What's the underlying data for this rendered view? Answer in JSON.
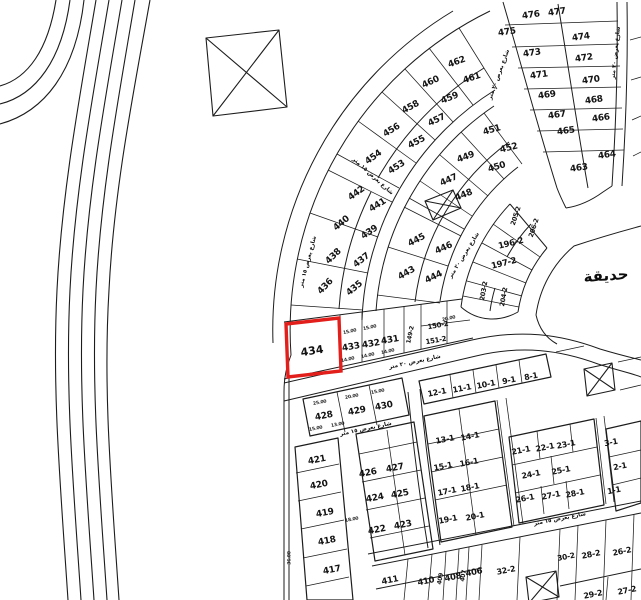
{
  "map": {
    "background_color": "#ffffff",
    "line_color": "#1c1c1c",
    "highlight_color": "#e31f1c",
    "park_label": "حديقة",
    "selected_plot": {
      "number": "434"
    },
    "plot_labels": [
      {
        "t": "435",
        "x": 355,
        "y": 289,
        "r": -40,
        "s": 9
      },
      {
        "t": "436",
        "x": 326,
        "y": 287,
        "r": -46,
        "s": 9
      },
      {
        "t": "437",
        "x": 362,
        "y": 261,
        "r": -38,
        "s": 9
      },
      {
        "t": "438",
        "x": 334,
        "y": 257,
        "r": -44,
        "s": 9
      },
      {
        "t": "439",
        "x": 370,
        "y": 233,
        "r": -34,
        "s": 9
      },
      {
        "t": "440",
        "x": 342,
        "y": 224,
        "r": -40,
        "s": 9
      },
      {
        "t": "441",
        "x": 378,
        "y": 206,
        "r": -32,
        "s": 9
      },
      {
        "t": "442",
        "x": 357,
        "y": 194,
        "r": -36,
        "s": 9
      },
      {
        "t": "453",
        "x": 397,
        "y": 168,
        "r": -33,
        "s": 9
      },
      {
        "t": "454",
        "x": 374,
        "y": 158,
        "r": -36,
        "s": 9
      },
      {
        "t": "455",
        "x": 417,
        "y": 143,
        "r": -28,
        "s": 9
      },
      {
        "t": "456",
        "x": 392,
        "y": 131,
        "r": -32,
        "s": 9
      },
      {
        "t": "457",
        "x": 437,
        "y": 121,
        "r": -26,
        "s": 9
      },
      {
        "t": "458",
        "x": 411,
        "y": 108,
        "r": -29,
        "s": 9
      },
      {
        "t": "459",
        "x": 450,
        "y": 99,
        "r": -22,
        "s": 9
      },
      {
        "t": "460",
        "x": 431,
        "y": 83,
        "r": -25,
        "s": 9
      },
      {
        "t": "461",
        "x": 472,
        "y": 79,
        "r": -18,
        "s": 9
      },
      {
        "t": "462",
        "x": 457,
        "y": 63,
        "r": -20,
        "s": 9
      },
      {
        "t": "443",
        "x": 407,
        "y": 274,
        "r": -30,
        "s": 9
      },
      {
        "t": "444",
        "x": 434,
        "y": 278,
        "r": -26,
        "s": 9
      },
      {
        "t": "445",
        "x": 417,
        "y": 241,
        "r": -28,
        "s": 9
      },
      {
        "t": "446",
        "x": 444,
        "y": 249,
        "r": -24,
        "s": 9
      },
      {
        "t": "447",
        "x": 449,
        "y": 181,
        "r": -24,
        "s": 9
      },
      {
        "t": "448",
        "x": 464,
        "y": 196,
        "r": -22,
        "s": 9
      },
      {
        "t": "449",
        "x": 466,
        "y": 158,
        "r": -20,
        "s": 9
      },
      {
        "t": "450",
        "x": 497,
        "y": 168,
        "r": -17,
        "s": 9
      },
      {
        "t": "451",
        "x": 492,
        "y": 131,
        "r": -16,
        "s": 9
      },
      {
        "t": "452",
        "x": 509,
        "y": 149,
        "r": -14,
        "s": 9
      },
      {
        "t": "433",
        "x": 351,
        "y": 348,
        "r": -10,
        "s": 9
      },
      {
        "t": "432",
        "x": 371,
        "y": 345,
        "r": -10,
        "s": 9
      },
      {
        "t": "431",
        "x": 390,
        "y": 341,
        "r": -10,
        "s": 9
      },
      {
        "t": "149-2",
        "x": 411,
        "y": 335,
        "r": -78,
        "s": 6
      },
      {
        "t": "150-2",
        "x": 438,
        "y": 326,
        "r": -10,
        "s": 7
      },
      {
        "t": "151-2",
        "x": 436,
        "y": 341,
        "r": -10,
        "s": 7
      },
      {
        "t": "205-2",
        "x": 516,
        "y": 216,
        "r": -72,
        "s": 6.5
      },
      {
        "t": "206-2",
        "x": 534,
        "y": 228,
        "r": -72,
        "s": 6.5
      },
      {
        "t": "196-2",
        "x": 511,
        "y": 244,
        "r": -14,
        "s": 8.5
      },
      {
        "t": "197-2",
        "x": 504,
        "y": 264,
        "r": -14,
        "s": 8.5
      },
      {
        "t": "203-2",
        "x": 484,
        "y": 291,
        "r": -80,
        "s": 6.5
      },
      {
        "t": "204-2",
        "x": 504,
        "y": 297,
        "r": -80,
        "s": 6.5
      },
      {
        "t": "476",
        "x": 531,
        "y": 16,
        "r": -8,
        "s": 9
      },
      {
        "t": "477",
        "x": 557,
        "y": 13,
        "r": -8,
        "s": 9
      },
      {
        "t": "475",
        "x": 507,
        "y": 33,
        "r": -8,
        "s": 9
      },
      {
        "t": "474",
        "x": 581,
        "y": 38,
        "r": -8,
        "s": 9
      },
      {
        "t": "473",
        "x": 532,
        "y": 54,
        "r": -8,
        "s": 9
      },
      {
        "t": "472",
        "x": 584,
        "y": 59,
        "r": -8,
        "s": 9
      },
      {
        "t": "471",
        "x": 539,
        "y": 76,
        "r": -8,
        "s": 9
      },
      {
        "t": "470",
        "x": 591,
        "y": 81,
        "r": -8,
        "s": 9
      },
      {
        "t": "469",
        "x": 547,
        "y": 96,
        "r": -8,
        "s": 9
      },
      {
        "t": "468",
        "x": 594,
        "y": 101,
        "r": -8,
        "s": 9
      },
      {
        "t": "467",
        "x": 557,
        "y": 116,
        "r": -8,
        "s": 9
      },
      {
        "t": "466",
        "x": 601,
        "y": 119,
        "r": -8,
        "s": 9
      },
      {
        "t": "465",
        "x": 566,
        "y": 132,
        "r": -8,
        "s": 9
      },
      {
        "t": "464",
        "x": 607,
        "y": 156,
        "r": -8,
        "s": 9
      },
      {
        "t": "463",
        "x": 579,
        "y": 169,
        "r": -8,
        "s": 9
      },
      {
        "t": "428",
        "x": 324,
        "y": 417,
        "r": -11,
        "s": 9
      },
      {
        "t": "429",
        "x": 357,
        "y": 412,
        "r": -11,
        "s": 9
      },
      {
        "t": "430",
        "x": 384,
        "y": 407,
        "r": -11,
        "s": 9
      },
      {
        "t": "421",
        "x": 317,
        "y": 461,
        "r": -11,
        "s": 9
      },
      {
        "t": "420",
        "x": 319,
        "y": 486,
        "r": -11,
        "s": 9
      },
      {
        "t": "419",
        "x": 325,
        "y": 514,
        "r": -11,
        "s": 9
      },
      {
        "t": "418",
        "x": 327,
        "y": 542,
        "r": -11,
        "s": 9
      },
      {
        "t": "417",
        "x": 332,
        "y": 571,
        "r": -11,
        "s": 9
      },
      {
        "t": "426",
        "x": 368,
        "y": 474,
        "r": -11,
        "s": 9
      },
      {
        "t": "427",
        "x": 395,
        "y": 469,
        "r": -11,
        "s": 9
      },
      {
        "t": "424",
        "x": 375,
        "y": 499,
        "r": -11,
        "s": 9
      },
      {
        "t": "425",
        "x": 400,
        "y": 495,
        "r": -11,
        "s": 9
      },
      {
        "t": "422",
        "x": 377,
        "y": 531,
        "r": -11,
        "s": 9
      },
      {
        "t": "423",
        "x": 403,
        "y": 526,
        "r": -11,
        "s": 9
      },
      {
        "t": "411",
        "x": 390,
        "y": 581,
        "r": -11,
        "s": 8.5
      },
      {
        "t": "410",
        "x": 426,
        "y": 582,
        "r": -11,
        "s": 8.5
      },
      {
        "t": "409",
        "x": 441,
        "y": 579,
        "r": -80,
        "s": 6
      },
      {
        "t": "408",
        "x": 453,
        "y": 578,
        "r": -11,
        "s": 8.5
      },
      {
        "t": "407",
        "x": 464,
        "y": 576,
        "r": -80,
        "s": 6
      },
      {
        "t": "406",
        "x": 474,
        "y": 573,
        "r": -11,
        "s": 8.5
      },
      {
        "t": "32-2",
        "x": 506,
        "y": 571,
        "r": -11,
        "s": 8
      },
      {
        "t": "30-2",
        "x": 566,
        "y": 557,
        "r": -11,
        "s": 7.5
      },
      {
        "t": "28-2",
        "x": 591,
        "y": 555,
        "r": -11,
        "s": 8
      },
      {
        "t": "26-2",
        "x": 622,
        "y": 552,
        "r": -11,
        "s": 8
      },
      {
        "t": "29-2",
        "x": 593,
        "y": 595,
        "r": -11,
        "s": 8
      },
      {
        "t": "27-2",
        "x": 627,
        "y": 591,
        "r": -11,
        "s": 8
      },
      {
        "t": "12-1",
        "x": 437,
        "y": 393,
        "r": -11,
        "s": 8
      },
      {
        "t": "11-1",
        "x": 462,
        "y": 389,
        "r": -11,
        "s": 8
      },
      {
        "t": "10-1",
        "x": 486,
        "y": 385,
        "r": -11,
        "s": 8
      },
      {
        "t": "9-1",
        "x": 509,
        "y": 381,
        "r": -11,
        "s": 8
      },
      {
        "t": "8-1",
        "x": 531,
        "y": 377,
        "r": -11,
        "s": 8
      },
      {
        "t": "13-1",
        "x": 445,
        "y": 440,
        "r": -11,
        "s": 8
      },
      {
        "t": "14-1",
        "x": 470,
        "y": 437,
        "r": -11,
        "s": 8
      },
      {
        "t": "15-1",
        "x": 443,
        "y": 467,
        "r": -11,
        "s": 8
      },
      {
        "t": "16-1",
        "x": 469,
        "y": 463,
        "r": -11,
        "s": 8
      },
      {
        "t": "17-1",
        "x": 447,
        "y": 492,
        "r": -11,
        "s": 8
      },
      {
        "t": "18-1",
        "x": 470,
        "y": 488,
        "r": -11,
        "s": 8
      },
      {
        "t": "19-1",
        "x": 448,
        "y": 520,
        "r": -11,
        "s": 8
      },
      {
        "t": "20-1",
        "x": 475,
        "y": 517,
        "r": -11,
        "s": 8
      },
      {
        "t": "21-1",
        "x": 521,
        "y": 451,
        "r": -11,
        "s": 8
      },
      {
        "t": "22-1",
        "x": 545,
        "y": 448,
        "r": -11,
        "s": 8
      },
      {
        "t": "23-1",
        "x": 566,
        "y": 445,
        "r": -11,
        "s": 8
      },
      {
        "t": "24-1",
        "x": 531,
        "y": 475,
        "r": -11,
        "s": 8
      },
      {
        "t": "25-1",
        "x": 561,
        "y": 471,
        "r": -11,
        "s": 8
      },
      {
        "t": "26-1",
        "x": 525,
        "y": 499,
        "r": -11,
        "s": 8
      },
      {
        "t": "27-1",
        "x": 551,
        "y": 496,
        "r": -11,
        "s": 8
      },
      {
        "t": "28-1",
        "x": 575,
        "y": 494,
        "r": -11,
        "s": 8
      },
      {
        "t": "3-1",
        "x": 611,
        "y": 443,
        "r": -11,
        "s": 8
      },
      {
        "t": "2-1",
        "x": 620,
        "y": 467,
        "r": -11,
        "s": 8
      },
      {
        "t": "1-1",
        "x": 614,
        "y": 491,
        "r": -11,
        "s": 8
      }
    ],
    "street_labels": [
      {
        "t": "شارع بعرض ٢٠ متر",
        "x": 415,
        "y": 363,
        "r": -12
      },
      {
        "t": "شارع بعرض ١٥ متر",
        "x": 366,
        "y": 430,
        "r": -12
      },
      {
        "t": "شارع بعرض ٢٠ متر",
        "x": 465,
        "y": 256,
        "r": -58
      },
      {
        "t": "شارع بعرض ٢٠ متر",
        "x": 500,
        "y": 75,
        "r": -70
      },
      {
        "t": "شارع بعرض ٢٠ متر",
        "x": 617,
        "y": 53,
        "r": -84
      },
      {
        "t": "شارع بعرض ١٥ متر",
        "x": 372,
        "y": 177,
        "r": 42
      },
      {
        "t": "شارع بعرض ١٥ متر",
        "x": 309,
        "y": 262,
        "r": -75
      },
      {
        "t": "شارع بعرض ١٥ متر",
        "x": 560,
        "y": 520,
        "r": -11
      }
    ],
    "dimension_labels": [
      {
        "t": "15.00",
        "x": 350,
        "y": 333,
        "r": -12
      },
      {
        "t": "15.00",
        "x": 370,
        "y": 329,
        "r": -12
      },
      {
        "t": "14.00",
        "x": 348,
        "y": 361,
        "r": -12
      },
      {
        "t": "14.00",
        "x": 368,
        "y": 357,
        "r": -12
      },
      {
        "t": "14.00",
        "x": 388,
        "y": 353,
        "r": -12
      },
      {
        "t": "25.00",
        "x": 320,
        "y": 404,
        "r": -11
      },
      {
        "t": "20.00",
        "x": 352,
        "y": 398,
        "r": -11
      },
      {
        "t": "15.00",
        "x": 378,
        "y": 393,
        "r": -11
      },
      {
        "t": "15.00",
        "x": 316,
        "y": 430,
        "r": -11
      },
      {
        "t": "13.00",
        "x": 338,
        "y": 426,
        "r": -11
      },
      {
        "t": "18.00",
        "x": 352,
        "y": 521,
        "r": -11
      },
      {
        "t": "36.00",
        "x": 291,
        "y": 558,
        "r": -90
      },
      {
        "t": "20.00",
        "x": 449,
        "y": 320,
        "r": -12
      }
    ]
  }
}
